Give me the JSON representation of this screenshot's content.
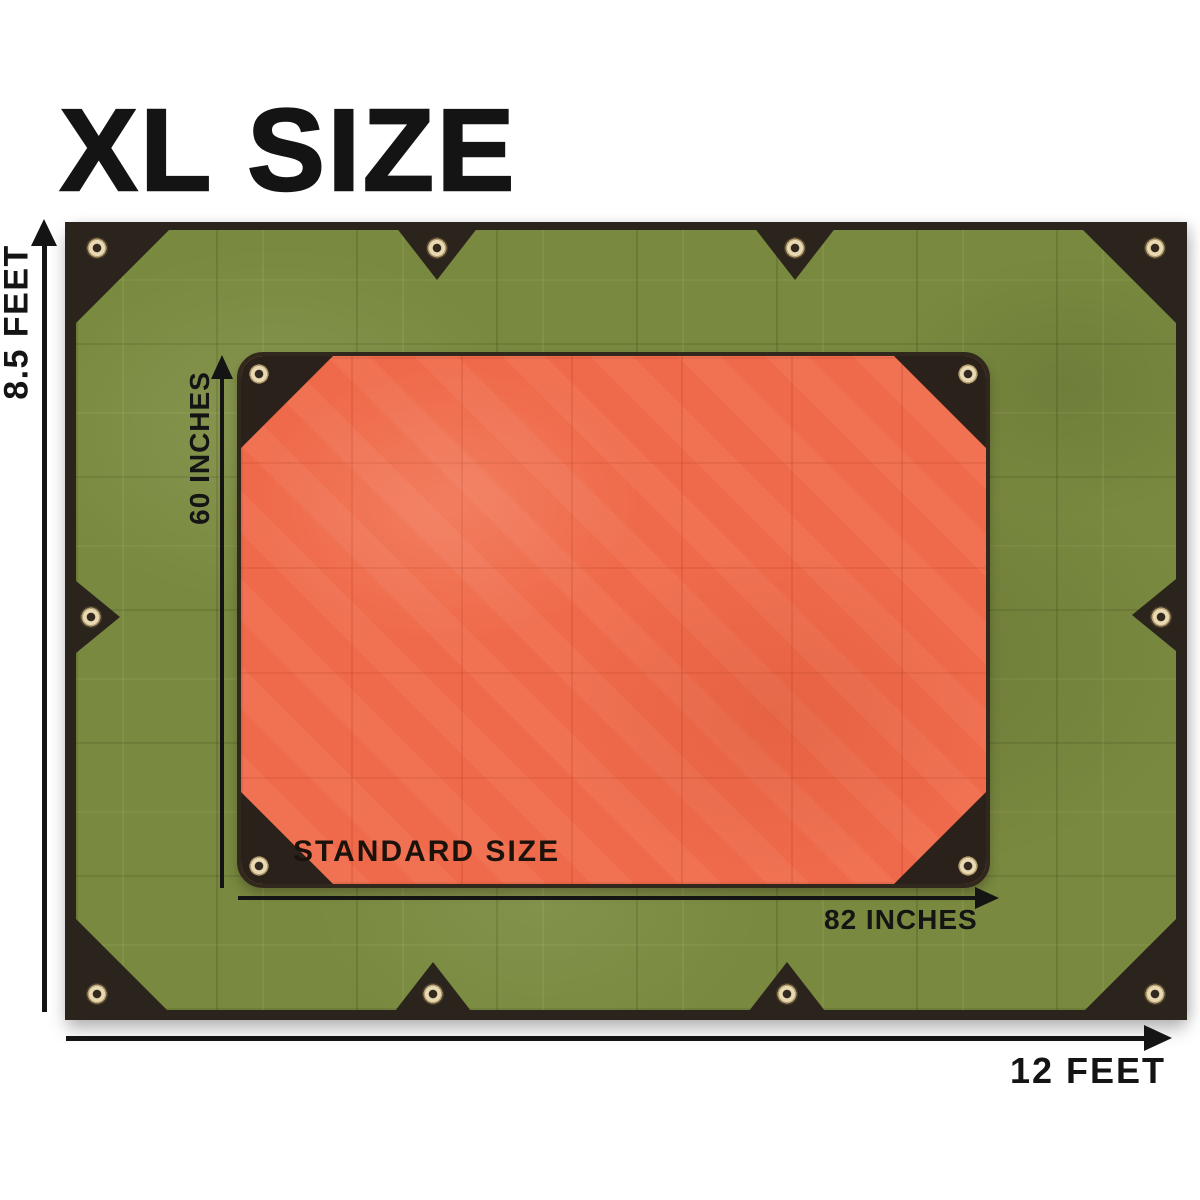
{
  "title": "XL SIZE",
  "diagram": {
    "xl_tarp": {
      "height_label": "8.5 FEET",
      "width_label": "12 FEET"
    },
    "standard_tarp": {
      "name_label": "STANDARD SIZE",
      "height_label": "60 INCHES",
      "width_label": "82 INCHES"
    }
  },
  "icons": {
    "grommet": "grommet-icon",
    "dimension_arrowhead": "arrow-head-icon"
  },
  "colors": {
    "background": "#ffffff",
    "xl_tarp_green": "#79893f",
    "standard_tarp_orange": "#ef6a4a",
    "trim_dark_brown": "#2b241d",
    "grommet_brass": "#e8d9b2",
    "annotation_black": "#141414"
  }
}
